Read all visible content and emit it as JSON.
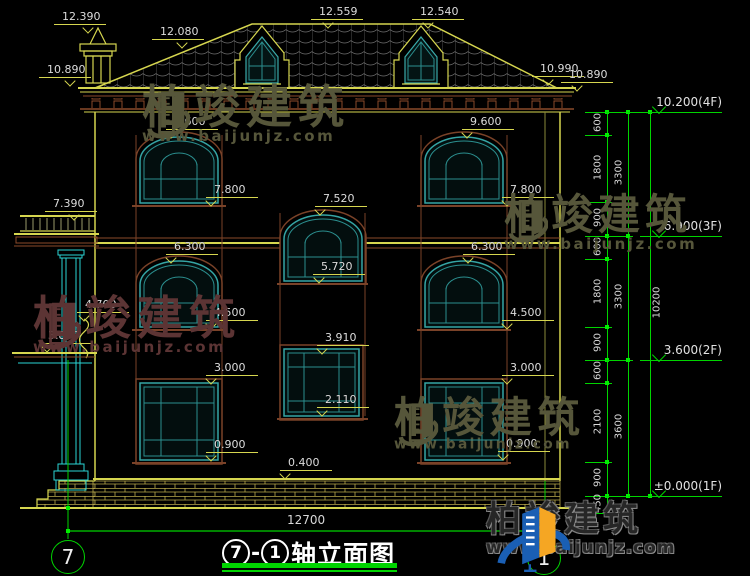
{
  "drawing": {
    "title": {
      "axis_start": "7",
      "axis_end": "1",
      "text": "轴立面图"
    },
    "bottom_dimension": "12700",
    "axis_bubble_left": "7",
    "axis_bubble_right": "1",
    "elevation_labels": [
      {
        "t": "12.390",
        "x": 62,
        "y": 11,
        "vx": 84
      },
      {
        "t": "12.080",
        "x": 160,
        "y": 26,
        "vx": 178
      },
      {
        "t": "12.559",
        "x": 319,
        "y": 6,
        "vx": 324
      },
      {
        "t": "12.540",
        "x": 420,
        "y": 6,
        "vx": 424
      },
      {
        "t": "10.890",
        "x": 47,
        "y": 64,
        "vx": 66
      },
      {
        "t": "10.990",
        "x": 540,
        "y": 63,
        "vx": 544
      },
      {
        "t": "10.890",
        "x": 569,
        "y": 69,
        "vx": 573
      },
      {
        "t": "9.600",
        "x": 174,
        "y": 116,
        "vx": 167
      },
      {
        "t": "9.600",
        "x": 470,
        "y": 116,
        "vx": 463
      },
      {
        "t": "7.800",
        "x": 214,
        "y": 184,
        "vx": 207
      },
      {
        "t": "7.800",
        "x": 510,
        "y": 184,
        "vx": 503
      },
      {
        "t": "7.520",
        "x": 323,
        "y": 193,
        "vx": 316
      },
      {
        "t": "5.720",
        "x": 321,
        "y": 261,
        "vx": 315
      },
      {
        "t": "6.300",
        "x": 174,
        "y": 241,
        "vx": 167
      },
      {
        "t": "6.300",
        "x": 471,
        "y": 241,
        "vx": 464
      },
      {
        "t": "4.500",
        "x": 214,
        "y": 307,
        "vx": 207
      },
      {
        "t": "4.500",
        "x": 510,
        "y": 307,
        "vx": 503
      },
      {
        "t": "3.000",
        "x": 214,
        "y": 362,
        "vx": 207
      },
      {
        "t": "3.000",
        "x": 510,
        "y": 362,
        "vx": 503
      },
      {
        "t": "3.910",
        "x": 325,
        "y": 332,
        "vx": 318
      },
      {
        "t": "2.110",
        "x": 325,
        "y": 394,
        "vx": 318
      },
      {
        "t": "0.900",
        "x": 214,
        "y": 439,
        "vx": 207
      },
      {
        "t": "0.900",
        "x": 506,
        "y": 438,
        "vx": 499
      },
      {
        "t": "0.400",
        "x": 288,
        "y": 457,
        "vx": 281
      },
      {
        "t": "7.390",
        "x": 53,
        "y": 198,
        "vx": 70
      },
      {
        "t": "4.700",
        "x": 85,
        "y": 299,
        "vx": 80
      },
      {
        "t": "3.800",
        "x": 48,
        "y": 330,
        "vx": 43
      }
    ],
    "chains": [
      {
        "x": 607,
        "tx": 598,
        "bounds": [
          10200,
          9600,
          7800,
          6900,
          6300,
          4500,
          3600,
          3000,
          900,
          0,
          -450
        ],
        "labels": [
          "600",
          "1800",
          "900",
          "600",
          "1800",
          "900",
          "600",
          "2100",
          "900",
          "450"
        ]
      },
      {
        "x": 628,
        "tx": 619,
        "bounds": [
          10200,
          6900,
          3600,
          0
        ],
        "labels": [
          "3300",
          "3300",
          "3600"
        ]
      },
      {
        "x": 650,
        "tx": 657,
        "bounds": [
          10200,
          0
        ],
        "labels": [
          "10200"
        ]
      }
    ],
    "level_flags": [
      {
        "label": "10.200(4F)",
        "mm": 10200
      },
      {
        "label": "6.900(3F)",
        "mm": 6900
      },
      {
        "label": "3.600(2F)",
        "mm": 3600
      },
      {
        "label": "±0.000(1F)",
        "mm": 0
      }
    ]
  },
  "brand": {
    "name": "柏竣建筑",
    "url": "www.baijunjz.com"
  },
  "colors": {
    "background": "#000000",
    "cad_yellow": "#d6d64f",
    "cad_white": "#dcdcdc",
    "dimension_green": "#00d400",
    "window_teal": "#2b8f8f",
    "trim_brown": "#8a4a2a",
    "column_cyan": "#2ad4d4",
    "watermark_olive": "#56563a",
    "watermark_maroon": "#5c3434",
    "logo_blue": "#1a5fb4",
    "logo_orange": "#f5a623"
  }
}
